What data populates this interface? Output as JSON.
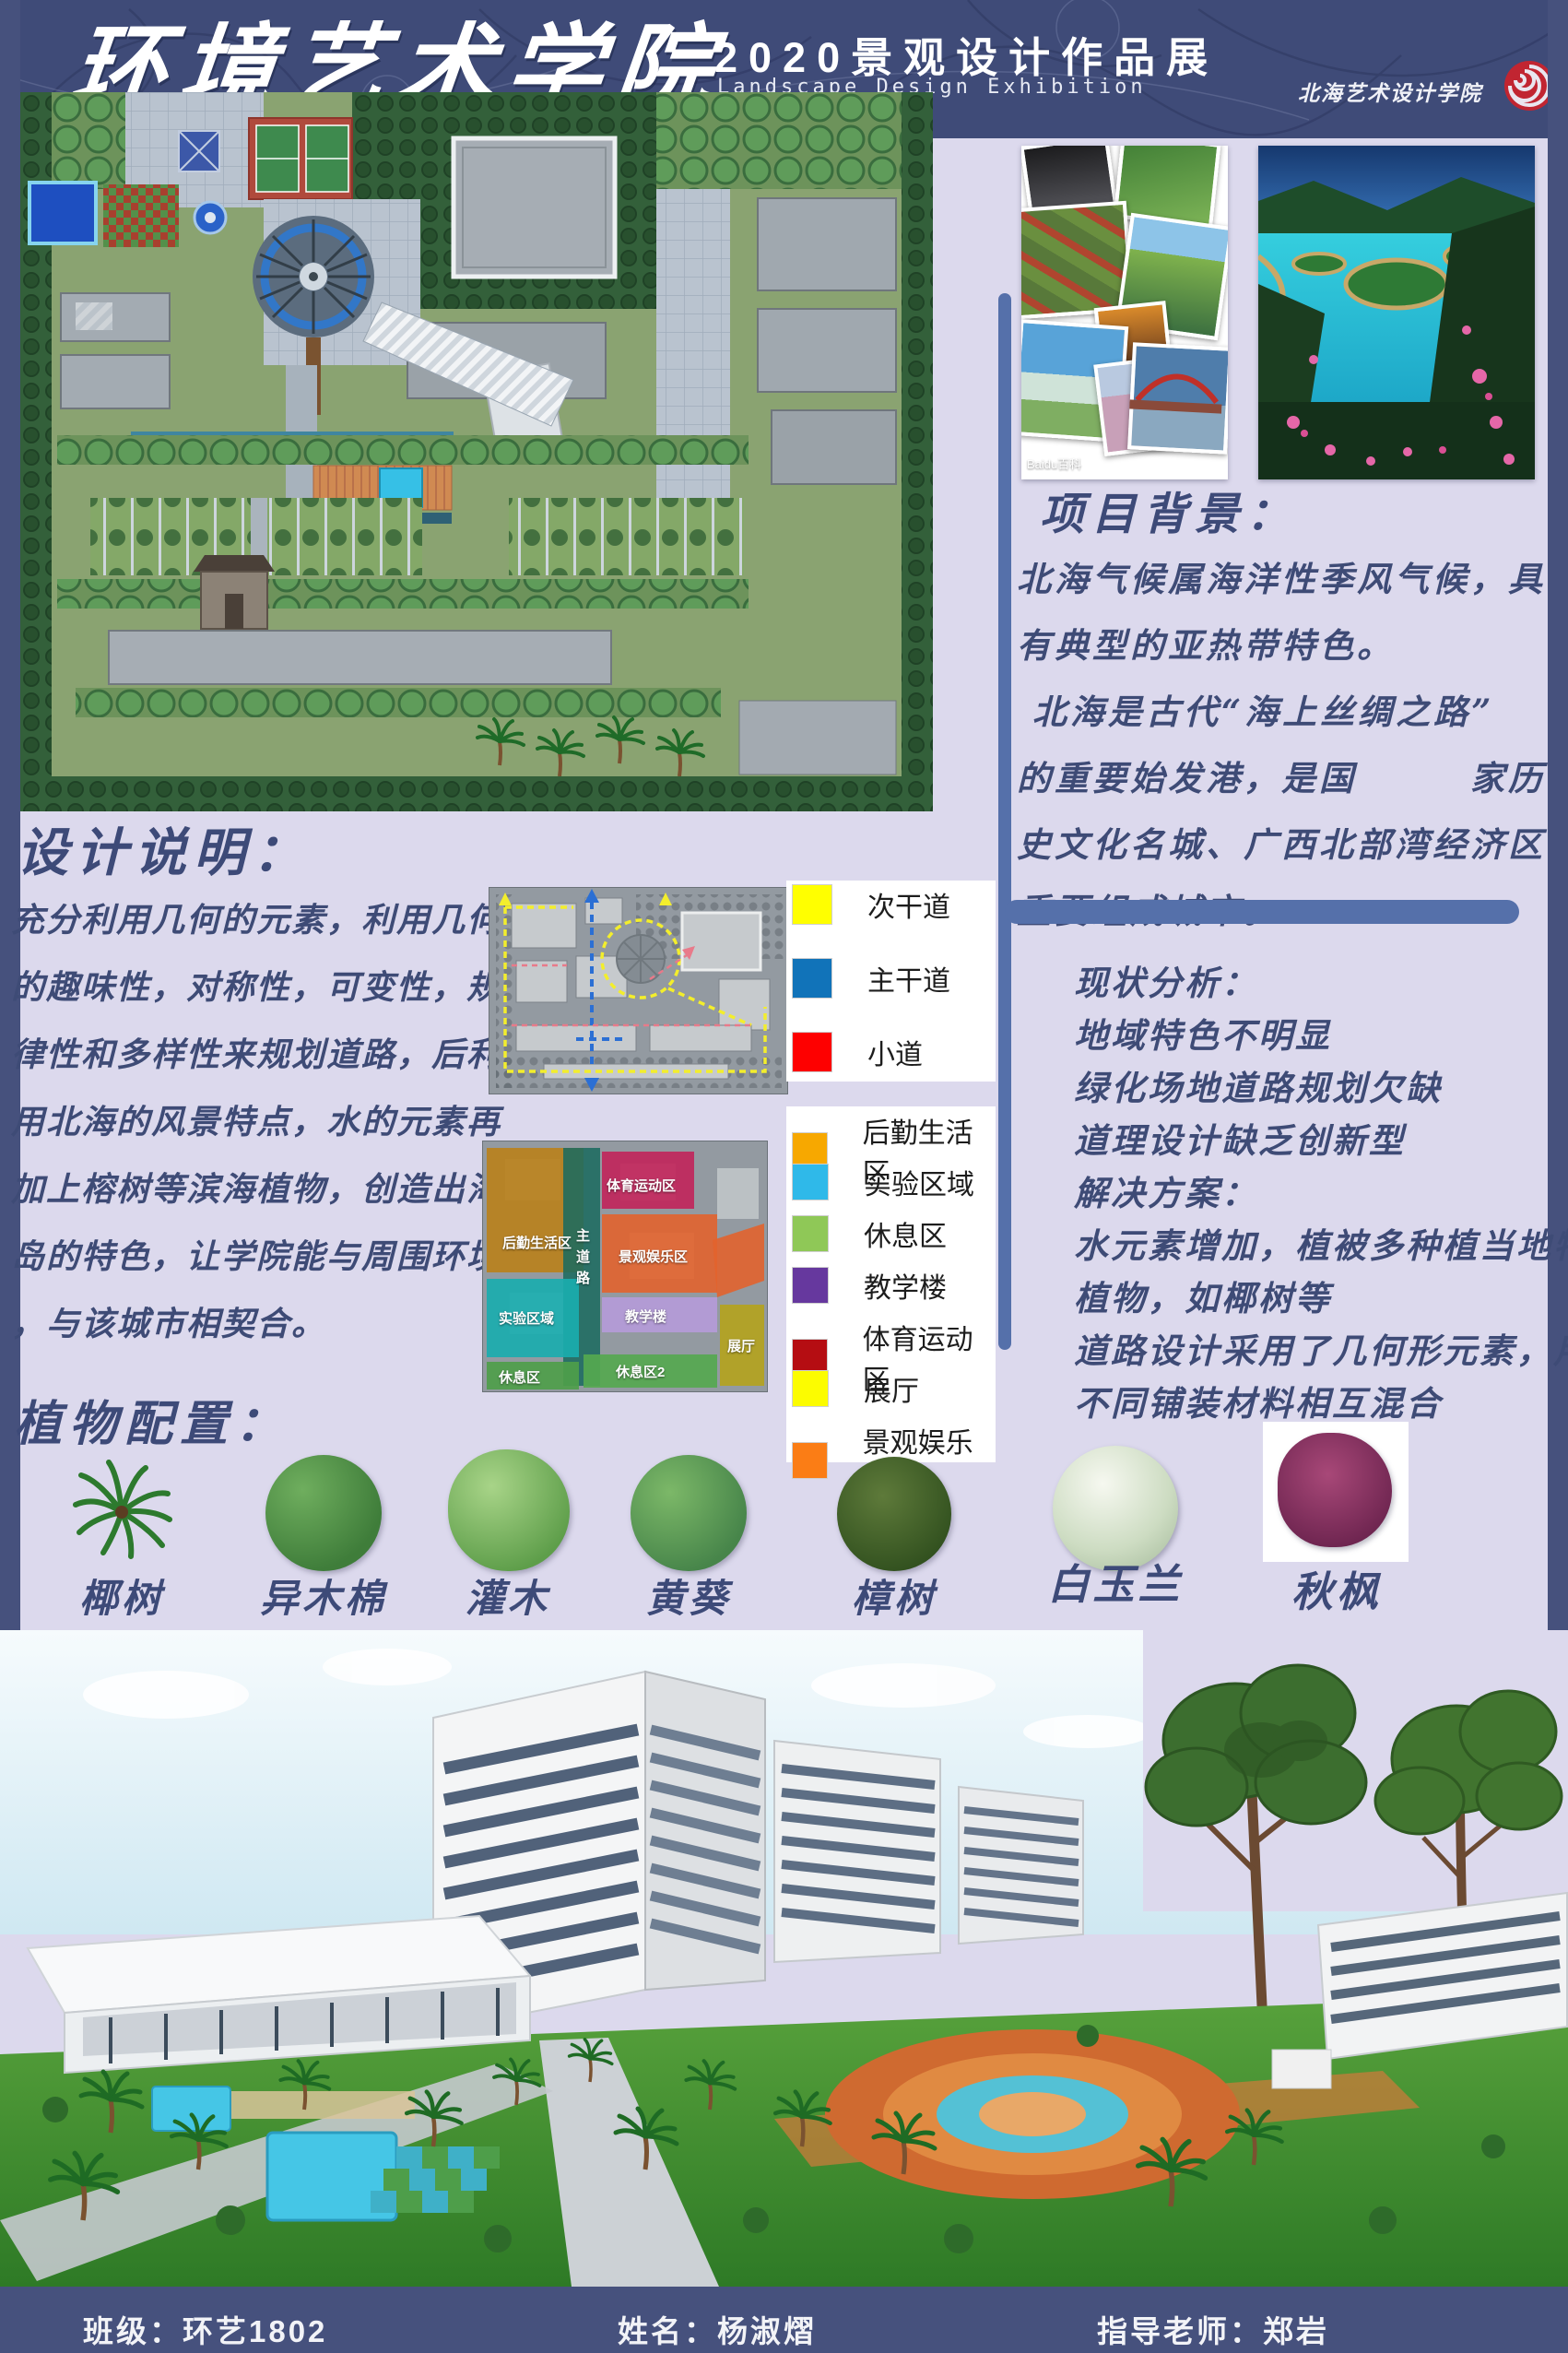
{
  "header": {
    "title": "环境艺术学院",
    "subtitle": "2020景观设计作品展",
    "subtitle_en": "Landscape Design Exhibition",
    "logo_text": "北海艺术设计学院"
  },
  "photos": {
    "collage_watermark": "Baidu百科"
  },
  "project_background": {
    "heading": "项目背景：",
    "lines": [
      "北海气候属海洋性季风气候，具",
      "有典型的亚热带特色。",
      " 北海是古代“海上丝绸之路”",
      "的重要始发港，是国　　　家历",
      "史文化名城、广西北部湾经济区",
      "重要组成城市。"
    ]
  },
  "design_notes": {
    "heading": "设计说明：",
    "lines": [
      "充分利用几何的元素，利用几何",
      "的趣味性，对称性，可变性，规",
      "律性和多样性来规划道路，后利",
      "用北海的风景特点，水的元素再",
      "加上榕树等滨海植物，创造出海",
      "岛的特色，让学院能与周围环境",
      "，与该城市相契合。"
    ]
  },
  "analysis": {
    "lines": [
      "现状分析：",
      "地域特色不明显",
      "绿化场地道路规划欠缺",
      "道理设计缺乏创新型",
      "解决方案：",
      "水元素增加，植被多种植当地特",
      "植物，如椰树等",
      "道路设计采用了几何形元素，用",
      "不同铺装材料相互混合"
    ]
  },
  "legend_roads": [
    {
      "label": "次干道",
      "color": "#ffff00"
    },
    {
      "label": "主干道",
      "color": "#1173b9"
    },
    {
      "label": "小道",
      "color": "#fe0000"
    }
  ],
  "legend_zones": [
    {
      "label": "后勤生活区",
      "color": "#f7a800"
    },
    {
      "label": "实验区域",
      "color": "#2fb9e9"
    },
    {
      "label": "休息区",
      "color": "#8fc857"
    },
    {
      "label": "教学楼",
      "color": "#66389e"
    },
    {
      "label": "体育运动区",
      "color": "#b50d12"
    },
    {
      "label": "展厅",
      "color": "#fcfc00"
    },
    {
      "label": "景观娱乐区",
      "color": "#fb7d15"
    }
  ],
  "zone_labels": [
    "后勤生活区",
    "主道路",
    "体育运动区",
    "景观娱乐区",
    "实验区域",
    "教学楼",
    "休息区",
    "休息区2",
    "展厅"
  ],
  "plants": {
    "heading": "植物配置：",
    "items": [
      "椰树",
      "异木棉",
      "灌木",
      "黄葵",
      "樟树",
      "白玉兰",
      "秋枫"
    ]
  },
  "footer": {
    "class_label": "班级：环艺1802",
    "name_label": "姓名：杨淑熠",
    "teacher_label": "指导老师：郑岩"
  }
}
